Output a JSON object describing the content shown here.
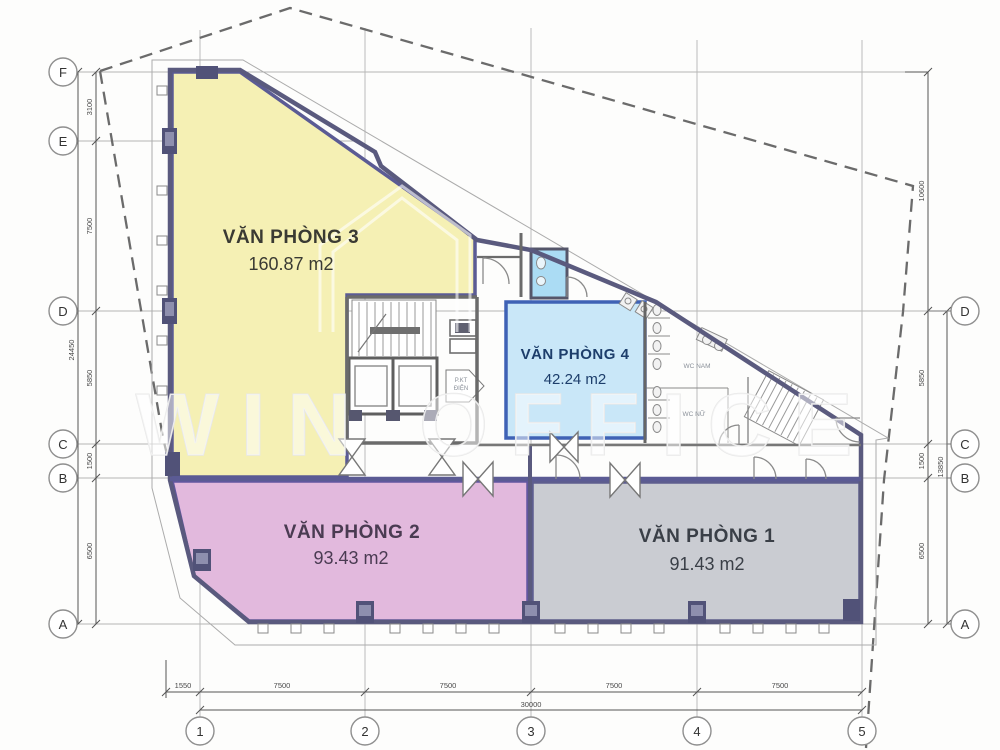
{
  "watermark": {
    "text": "WIN OFFICE"
  },
  "rooms": [
    {
      "name": "VĂN PHÒNG 3",
      "area": "160.87 m2",
      "fill": "#f5f0b4",
      "text_color": "#3a3a33"
    },
    {
      "name": "VĂN PHÒNG 4",
      "area": "42.24 m2",
      "fill": "#c9e7f8",
      "text_color": "#1d3e6b"
    },
    {
      "name": "VĂN PHÒNG 2",
      "area": "93.43 m2",
      "fill": "#e2b9dd",
      "text_color": "#4a3b52"
    },
    {
      "name": "VĂN PHÒNG 1",
      "area": "91.43 m2",
      "fill": "#caccd2",
      "text_color": "#3a3f47"
    }
  ],
  "annotations": {
    "wc_nam": "WC NAM",
    "wc_nu": "WC NỮ",
    "pkt_line1": "P.KT",
    "pkt_line2": "ĐIỆN"
  },
  "grid": {
    "left": [
      "F",
      "E",
      "D",
      "C",
      "B",
      "A"
    ],
    "right": [
      "D",
      "C",
      "B",
      "A"
    ],
    "bottom": [
      "1",
      "2",
      "3",
      "4",
      "5"
    ]
  },
  "dims": {
    "left": [
      "3100",
      "7500",
      "5850",
      "1500",
      "6500"
    ],
    "left_total": "24450",
    "right": [
      "10600",
      "5850",
      "1500",
      "6500"
    ],
    "right_total": "13850",
    "bottom": [
      "1550",
      "7500",
      "7500",
      "7500",
      "7500"
    ],
    "bottom_total": "30000"
  },
  "colors": {
    "wall": "#5a5a7e",
    "room_border": "#5b5b94",
    "vp4_border": "#3f62b5",
    "grid_line": "#b5b5b5",
    "dashed_boundary": "#6b6b6b",
    "dim_text": "#4a4a4a"
  }
}
